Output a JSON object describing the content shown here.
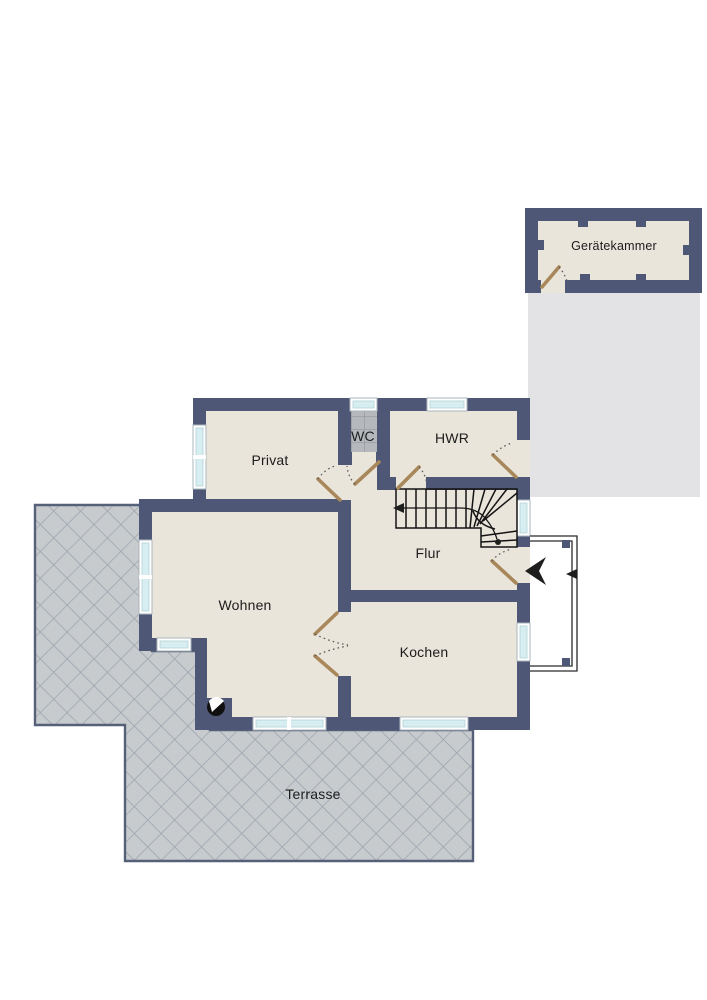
{
  "title": "Grundriss Erdgeschoss",
  "floorplan": {
    "rooms": [
      {
        "id": "geraetekammer",
        "label": "Gerätekammer"
      },
      {
        "id": "privat",
        "label": "Privat"
      },
      {
        "id": "wc",
        "label": "WC"
      },
      {
        "id": "hwr",
        "label": "HWR"
      },
      {
        "id": "flur",
        "label": "Flur"
      },
      {
        "id": "wohnen",
        "label": "Wohnen"
      },
      {
        "id": "kochen",
        "label": "Kochen"
      },
      {
        "id": "terrasse",
        "label": "Terrasse"
      }
    ],
    "colors": {
      "background": "#ffffff",
      "wall": "#4e5775",
      "floor": "#eae5db",
      "wc_floor": "#b5b9be",
      "terrace_tile": "#c7cbce",
      "terrace_line": "#9aa2ab",
      "terrace_border": "#566078",
      "shadow": "#e3e3e5",
      "window_glass": "#d6edf1",
      "door": "#a8875a",
      "stair_line": "#141414"
    }
  }
}
